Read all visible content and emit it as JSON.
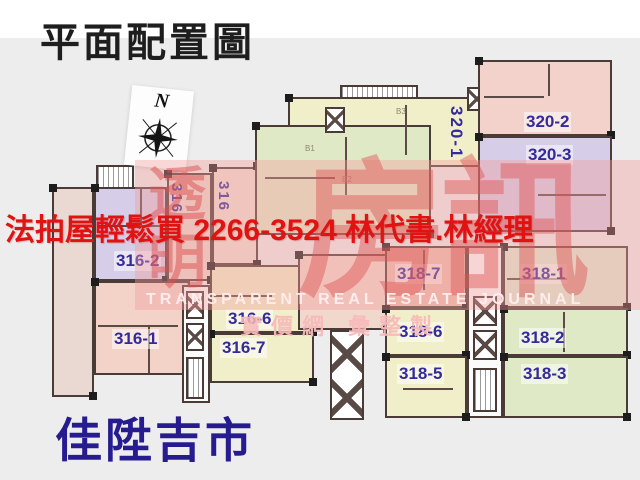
{
  "header": {
    "title": "平面配置圖"
  },
  "compass": {
    "label": "N"
  },
  "ad_banner": {
    "text": "法拍屋輕鬆買  2266-3524  林代書.林經理"
  },
  "watermark": {
    "vertical_text": "透明",
    "big_text": "房訊",
    "line_en": "TRANSPARENT REAL ESTATE JOURNAL",
    "line_zh": "實價網 彙整製"
  },
  "footer": {
    "project_name": "佳陞吉市"
  },
  "units": {
    "u316_1": "316-1",
    "u316_2": "316-2",
    "u316_6": "316-6",
    "u316_7": "316-7",
    "u316_va": "316",
    "u316_vb": "316",
    "u318_1": "318-1",
    "u318_2": "318-2",
    "u318_3": "318-3",
    "u318_5": "318-5",
    "u318_6": "318-6",
    "u318_7": "318-7",
    "u320_1": "320-1",
    "u320_2": "320-2",
    "u320_3": "320-3"
  },
  "rooms": {
    "b1": "B1",
    "b2": "B2",
    "b3": "B3"
  },
  "colors": {
    "bg": "#ededed",
    "ad_red": "#e11212",
    "footer_navy": "#271b90",
    "unit_label": "#342a99",
    "wm_pink": "#df5454",
    "lavender": "#d6cde8",
    "pink": "#f3d2c8",
    "salmon": "#edbfae",
    "yellow": "#f1efc9",
    "green": "#dfe9c6",
    "wall": "#4a3b36"
  }
}
